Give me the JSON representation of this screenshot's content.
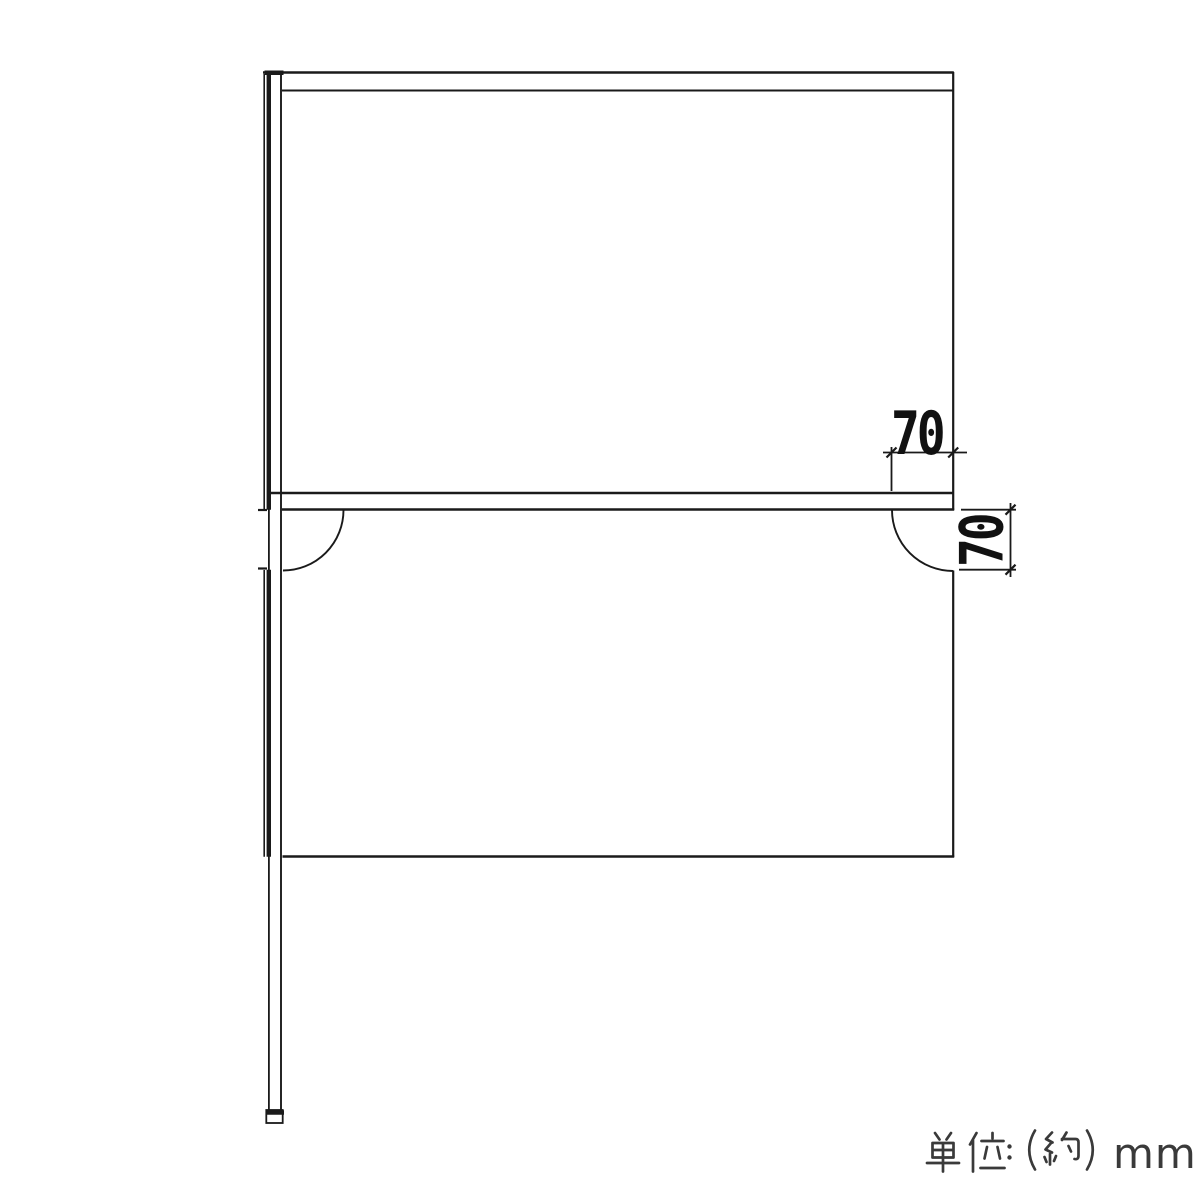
{
  "drawing": {
    "kind": "technical dimension side-view diagram",
    "background": "#ffffff",
    "line_color": "#1a1a1a",
    "parts": [
      "support-pole",
      "pole-foot",
      "top-board-edge",
      "upper-panel",
      "middle-shelf-edge",
      "lower-panel",
      "corner-notch-arc-left",
      "corner-notch-arc-right"
    ]
  },
  "dimensions": {
    "horizontal": {
      "label": "70",
      "value": 70,
      "unit": "mm",
      "orientation": "horizontal",
      "measures": "notch width"
    },
    "vertical": {
      "label": "70",
      "value": 70,
      "unit": "mm",
      "orientation": "vertical",
      "measures": "notch height"
    }
  },
  "note": {
    "full_text": "単位：（約）mm",
    "unit_label": "単位",
    "colon": "：",
    "paren_open": "（",
    "approx": "約",
    "paren_close": "）",
    "unit": "mm",
    "color": "#3a3a3a"
  }
}
